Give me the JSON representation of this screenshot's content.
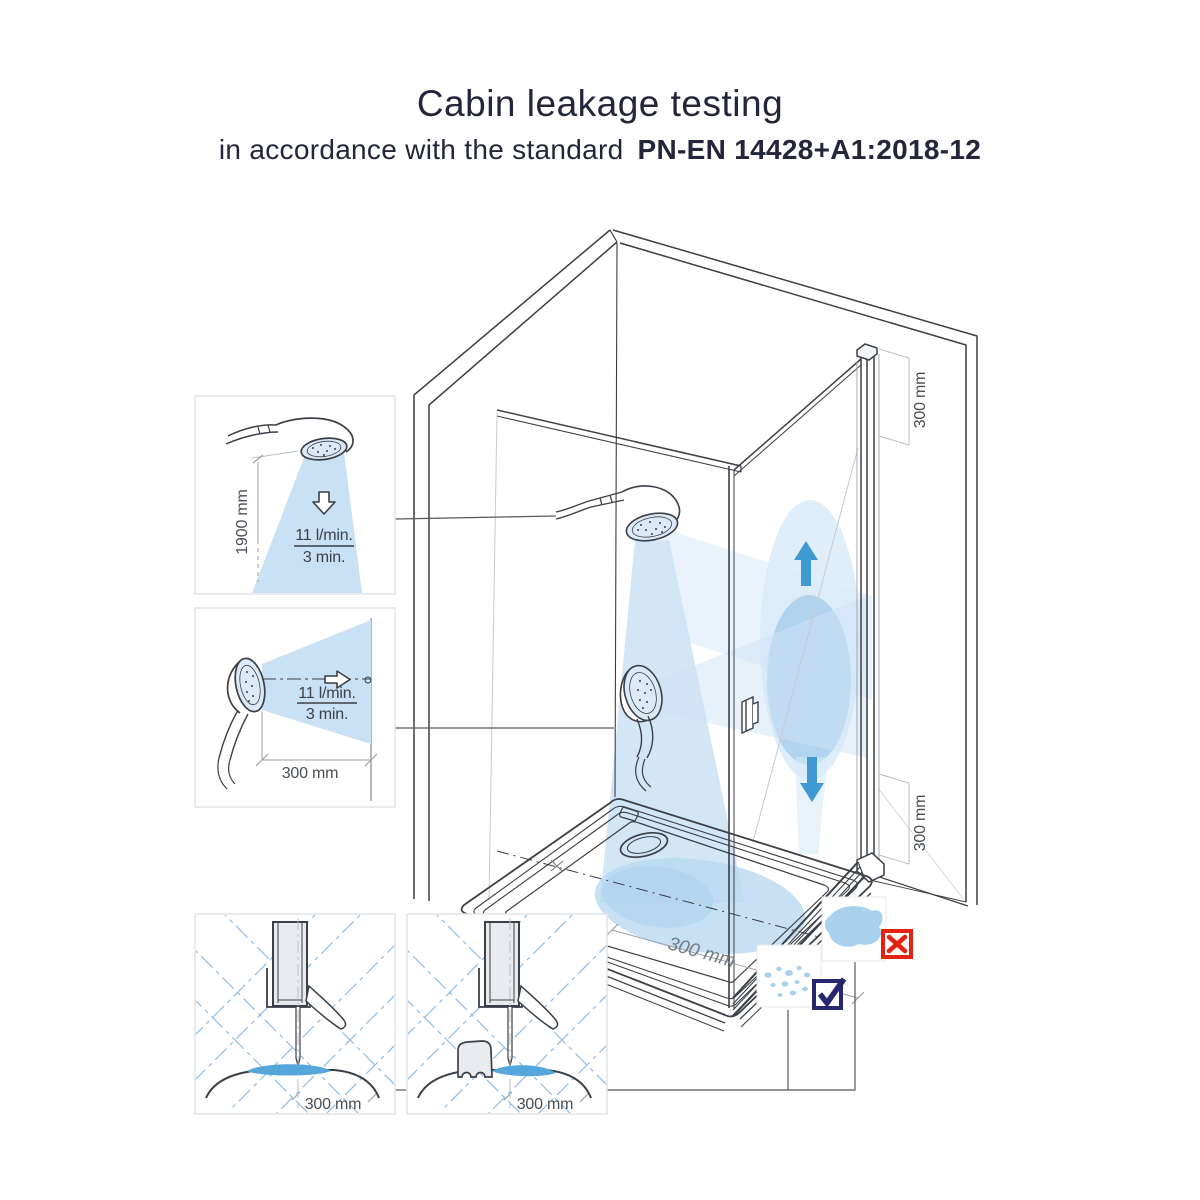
{
  "title": {
    "main": "Cabin leakage testing",
    "subtitle_prefix": "in accordance with the standard",
    "subtitle_standard": "PN-EN 14428+A1:2018-12"
  },
  "insets": {
    "overhead_spray_test": {
      "height_dimension": "1900 mm",
      "flow_rate": "11 l/min.",
      "duration": "3 min.",
      "arrow_icon": "arrow-down-outline-icon"
    },
    "horizontal_spray_test": {
      "distance_dimension": "300 mm",
      "flow_rate": "11 l/min.",
      "duration": "3 min.",
      "arrow_icon": "arrow-right-outline-icon"
    },
    "seal_detail_plain": {
      "distance_dimension": "300 mm"
    },
    "seal_detail_with_sponge": {
      "distance_dimension": "300 mm"
    }
  },
  "cabin": {
    "door_top_dimension": "300 mm",
    "door_bottom_dimension": "300 mm",
    "tray_dimension": "300 mm",
    "spray_up_icon": "arrow-up-icon",
    "spray_down_icon": "arrow-down-icon"
  },
  "results": {
    "fail_icon": "x-mark-icon",
    "pass_icon": "check-mark-icon"
  },
  "colors": {
    "line_dark": "#3b3f47",
    "dim_gray": "#9aa0a8",
    "spray_light": "#cfe4f5",
    "spray_mid": "#a9cfec",
    "puddle_blue": "#55a6db",
    "arrow_blue": "#3f9ad2",
    "fail_red": "#e42313",
    "pass_navy": "#27276f"
  }
}
